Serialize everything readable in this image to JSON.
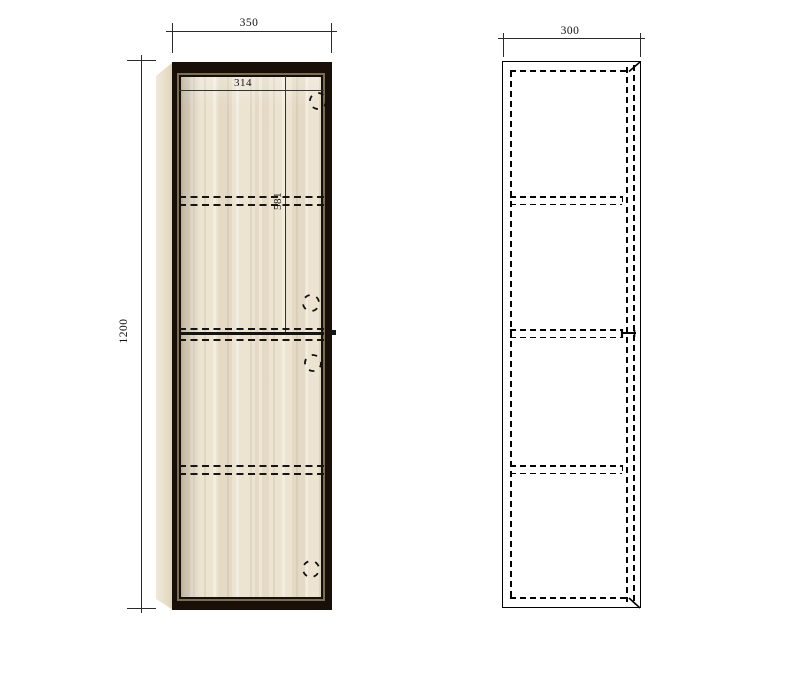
{
  "drawing": {
    "type": "cabinet technical drawing",
    "front_view": {
      "name": "front view",
      "dims": {
        "overall_width": "350",
        "overall_height": "1200",
        "inner_width": "314",
        "upper_door_height": "581"
      }
    },
    "side_view": {
      "name": "side view",
      "dims": {
        "depth": "300"
      }
    },
    "colors": {
      "background": "#ffffff",
      "line": "#1a1a1a",
      "frame_dark": "#170f08",
      "frame_mid": "#7e6d50",
      "wood": "#ece3d1",
      "wood_side": "#e9dfcb"
    }
  }
}
